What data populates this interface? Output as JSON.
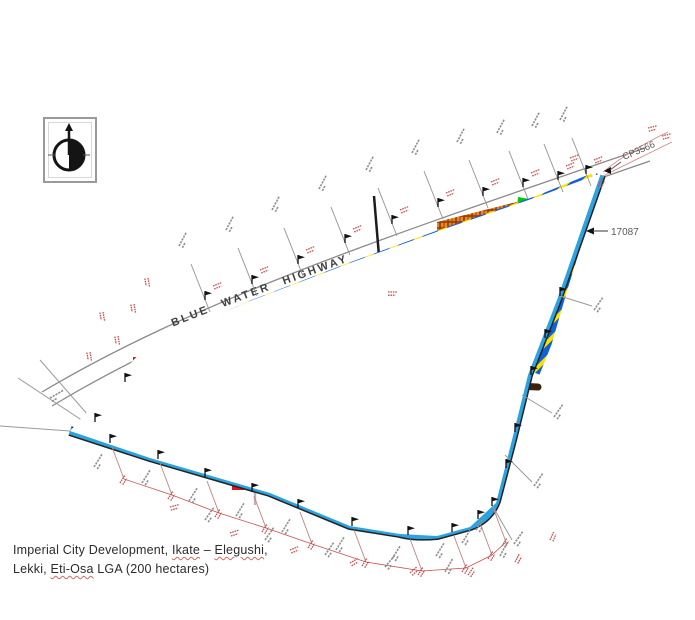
{
  "figure": {
    "highway_label": "BLUE WATER HIGHWAY",
    "callouts": {
      "right_edge": "17087",
      "apex": "CP3566"
    },
    "north_arrow_icon": "north-arrow"
  },
  "caption": {
    "line1": {
      "prefix": "Imperial City Development, ",
      "ikate": "Ikate",
      "dash": " – ",
      "elegushi": "Elegushi",
      "suffix": ","
    },
    "line2": {
      "prefix": "Lekki, ",
      "eti_osa": "Eti-Osa",
      "suffix": " LGA (200 hectares)"
    }
  },
  "colors": {
    "plots_yellow": "#FFE100",
    "plots_orange": "#EE8422",
    "plots_tan": "#E6CF96",
    "plots_dark_brown": "#8A7434",
    "open_space_green": "#00CC00",
    "institutional_blue": "#1414D2",
    "special_red": "#E11414",
    "accent_magenta": "#E81EE8",
    "perimeter_road_cyan": "#2BA3E0",
    "hatch_blue": "#1060D8",
    "hatch_yellow": "#FFE100",
    "main_road_brown": "#3A2410",
    "internal_road_grey": "#B8B8B8",
    "survey_text_red": "#C65050",
    "survey_line_grey": "#8F8F8F"
  }
}
